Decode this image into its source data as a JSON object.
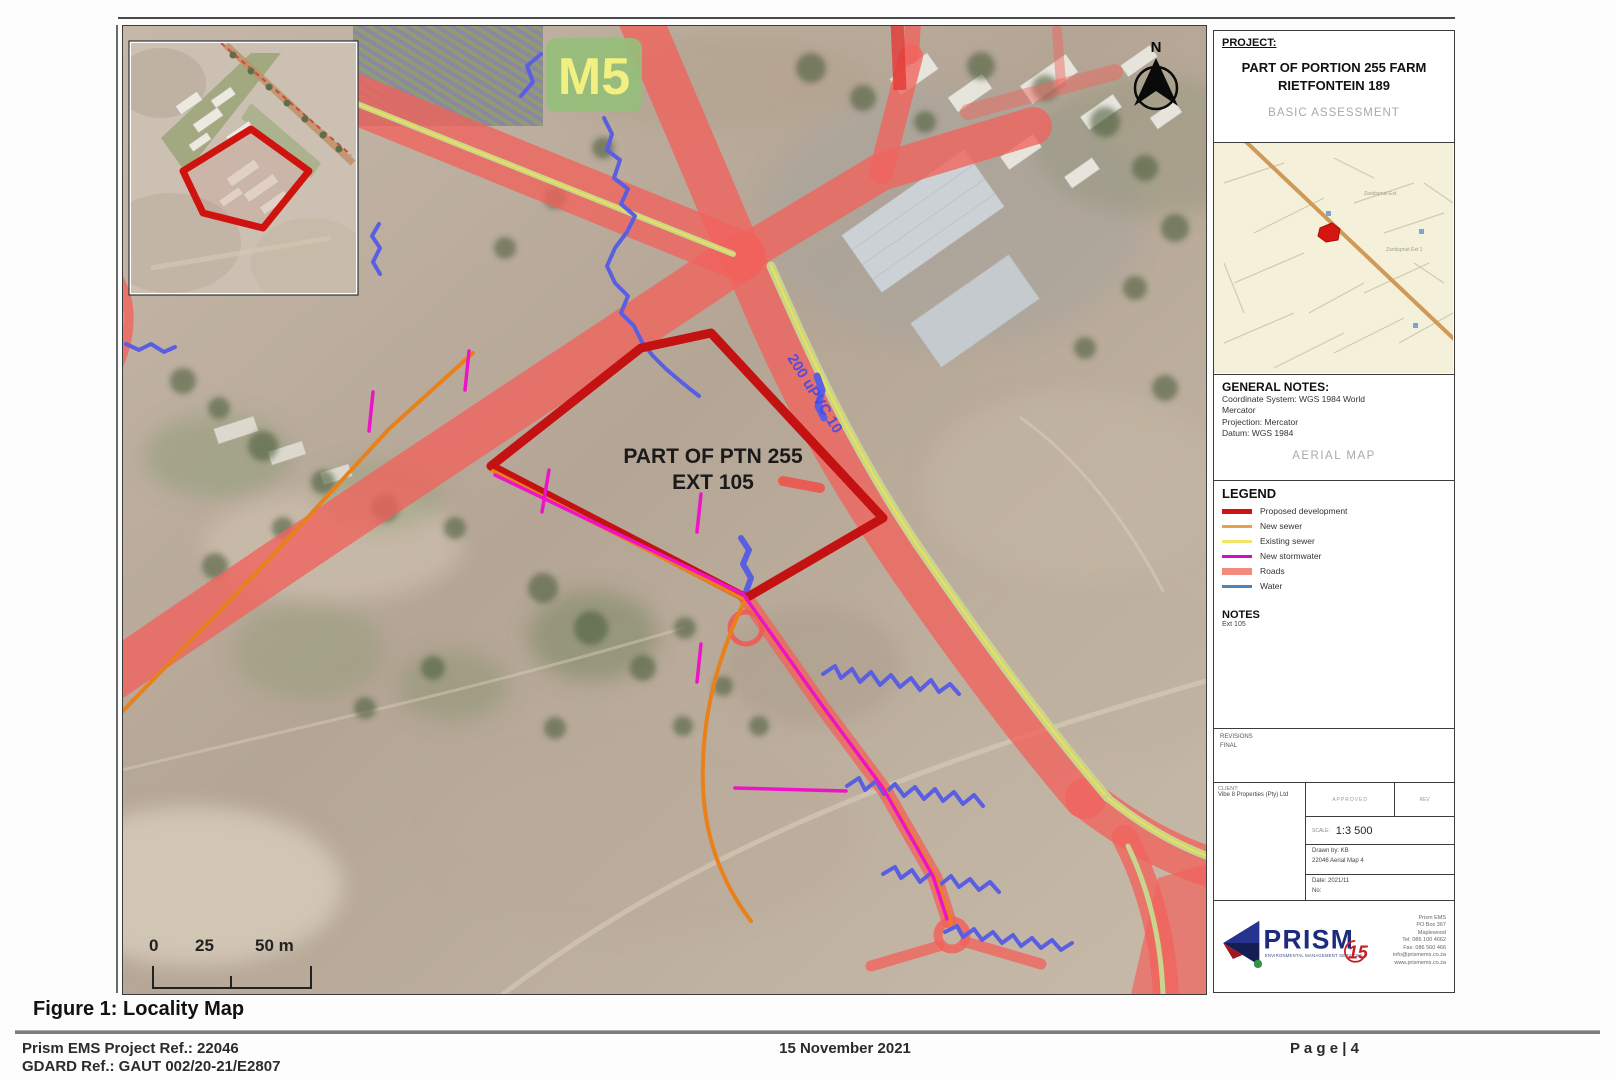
{
  "page": {
    "figure_caption": "Figure 1: Locality Map",
    "footer": {
      "ref_line1": "Prism EMS Project Ref.: 22046",
      "ref_line2": "GDARD Ref.:  GAUT 002/20-21/E2807",
      "date": "15 November 2021",
      "page_label": "P a g e | 4"
    }
  },
  "map": {
    "route_marker": "M5",
    "site_label_line1": "PART OF PTN 255",
    "site_label_line2": "EXT 105",
    "pipe_label": "200 uPVC 10",
    "north_label": "N",
    "scale_bar": {
      "tick0": "0",
      "tick25": "25",
      "tick50": "50 m"
    }
  },
  "panel": {
    "project": {
      "heading": "PROJECT:",
      "title_line1": "PART OF PORTION 255 FARM",
      "title_line2": "RIETFONTEIN 189",
      "subtitle": "BASIC ASSESSMENT"
    },
    "locality_inset": {
      "label1": "Zandspruit Ext",
      "label2": "Zandspruit Ext 1"
    },
    "general_notes": {
      "heading": "GENERAL NOTES:",
      "line1": "Coordinate System: WGS 1984 World",
      "line2": "Mercator",
      "line3": "Projection: Mercator",
      "line4": "Datum: WGS 1984",
      "subtitle": "AERIAL MAP"
    },
    "legend": {
      "heading": "LEGEND",
      "items": [
        {
          "label": "Proposed development",
          "swatch_style": "background:#cf1212;height:5px"
        },
        {
          "label": "New sewer",
          "swatch_style": "background:#e8a04c;height:3px"
        },
        {
          "label": "Existing sewer",
          "swatch_style": "background:#f2e469;height:3px"
        },
        {
          "label": "New stormwater",
          "swatch_style": "background:#cc10c4;height:3px"
        },
        {
          "label": "Roads",
          "swatch_style": "background:#f28a7e;height:7px"
        },
        {
          "label": "Water",
          "swatch_style": "background:#4a86b8;height:3px"
        }
      ],
      "notes_heading": "NOTES",
      "notes_text": "Ext 105"
    },
    "revisions": {
      "line1": "REVISIONS",
      "line2": "FINAL"
    },
    "titleblock": {
      "client_heading": "CLIENT:",
      "client_name": "Vibe 8 Properties (Pty) Ltd",
      "cell_approved": "APPROVED",
      "cell_rev": "REV",
      "scale_label": "SCALE:",
      "scale_value": "1:3 500",
      "drawn_by": "Drawn by: KB",
      "drawing_no": "22046 Aerial Map 4",
      "date_label": "Date: 2021/11",
      "no_label": "No:"
    },
    "prism": {
      "name": "PRISM",
      "tagline": "ENVIRONMENTAL MANAGEMENT SERVICES",
      "badge": "15",
      "address_line1": "Prism EMS",
      "address_line2": "PO Box 367",
      "address_line3": "Maplewood",
      "address_line4": "Tel: 086 100 4662",
      "address_line5": "Fax: 086 560 466",
      "address_line6": "info@prismems.co.za",
      "address_line7": "www.prismems.co.za"
    }
  }
}
